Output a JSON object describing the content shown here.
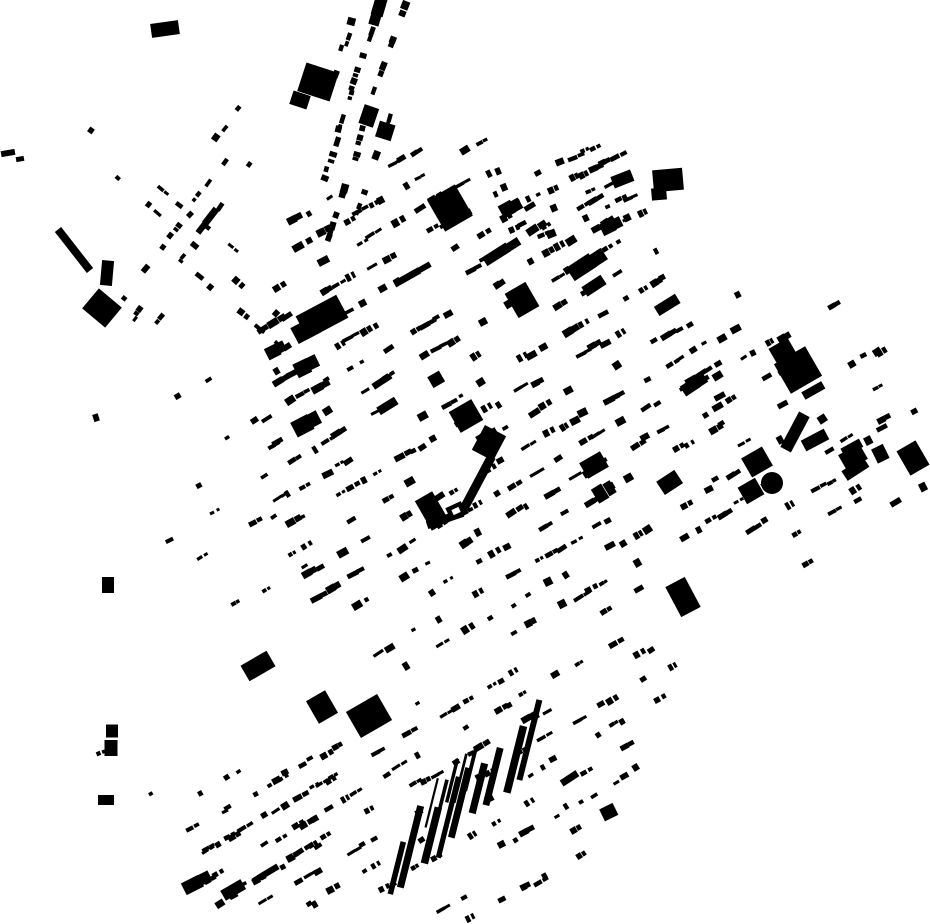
{
  "map": {
    "description": "Figure-ground map: black building footprints on white, city grid rotated about 30 degrees",
    "width": 930,
    "height": 924,
    "background_color": "#ffffff",
    "building_color": "#000000",
    "seed": 1337,
    "grid_angle_deg": -30,
    "districts": [
      {
        "name": "core",
        "angle": -30,
        "cell": [
          14,
          26
        ],
        "prob": 0.62,
        "jitter": 5,
        "block_every": 5,
        "cluster_prob": 0.5,
        "w": [
          4,
          12
        ],
        "h": [
          3,
          8
        ],
        "big_prob": 0.06,
        "poly": [
          [
            295,
            190
          ],
          [
            470,
            128
          ],
          [
            560,
            168
          ],
          [
            660,
            248
          ],
          [
            755,
            400
          ],
          [
            735,
            520
          ],
          [
            640,
            600
          ],
          [
            520,
            650
          ],
          [
            395,
            670
          ],
          [
            300,
            600
          ],
          [
            255,
            450
          ],
          [
            255,
            300
          ]
        ]
      },
      {
        "name": "south",
        "angle": -30,
        "cell": [
          13,
          24
        ],
        "prob": 0.55,
        "jitter": 5,
        "block_every": 5,
        "cluster_prob": 0.5,
        "w": [
          4,
          10
        ],
        "h": [
          3,
          7
        ],
        "big_prob": 0.04,
        "poly": [
          [
            250,
            770
          ],
          [
            420,
            700
          ],
          [
            600,
            640
          ],
          [
            690,
            650
          ],
          [
            640,
            780
          ],
          [
            555,
            900
          ],
          [
            470,
            924
          ],
          [
            240,
            915
          ],
          [
            185,
            850
          ]
        ]
      },
      {
        "name": "east",
        "angle": -30,
        "cell": [
          15,
          30
        ],
        "prob": 0.45,
        "jitter": 6,
        "block_every": 5,
        "cluster_prob": 0.45,
        "w": [
          4,
          11
        ],
        "h": [
          3,
          8
        ],
        "big_prob": 0.1,
        "poly": [
          [
            700,
            280
          ],
          [
            830,
            300
          ],
          [
            880,
            330
          ],
          [
            900,
            420
          ],
          [
            880,
            520
          ],
          [
            800,
            570
          ],
          [
            735,
            540
          ],
          [
            700,
            480
          ],
          [
            685,
            380
          ]
        ]
      },
      {
        "name": "far-east",
        "angle": -30,
        "cell": [
          18,
          36
        ],
        "prob": 0.24,
        "jitter": 7,
        "block_every": 0,
        "cluster_prob": 0.3,
        "w": [
          5,
          12
        ],
        "h": [
          4,
          9
        ],
        "big_prob": 0.15,
        "poly": [
          [
            820,
            300
          ],
          [
            930,
            330
          ],
          [
            930,
            520
          ],
          [
            860,
            540
          ],
          [
            842,
            430
          ],
          [
            828,
            350
          ]
        ]
      },
      {
        "name": "northeast-cluster",
        "angle": -25,
        "cell": [
          12,
          20
        ],
        "prob": 0.62,
        "jitter": 4,
        "block_every": 6,
        "cluster_prob": 0.5,
        "w": [
          4,
          10
        ],
        "h": [
          3,
          8
        ],
        "big_prob": 0.12,
        "poly": [
          [
            492,
            150
          ],
          [
            605,
            146
          ],
          [
            660,
            205
          ],
          [
            612,
            248
          ],
          [
            515,
            235
          ],
          [
            478,
            190
          ]
        ]
      },
      {
        "name": "north-corridor",
        "angle": 108,
        "cell": [
          13,
          22
        ],
        "prob": 0.58,
        "jitter": 4,
        "block_every": 0,
        "cluster_prob": 0.4,
        "w": [
          5,
          10
        ],
        "h": [
          4,
          8
        ],
        "big_prob": 0.05,
        "poly": [
          [
            336,
            0
          ],
          [
            412,
            0
          ],
          [
            374,
            238
          ],
          [
            320,
            238
          ]
        ]
      },
      {
        "name": "nw-corridor-a",
        "angle": 40,
        "cell": [
          13,
          22
        ],
        "prob": 0.5,
        "jitter": 4,
        "block_every": 0,
        "cluster_prob": 0.4,
        "w": [
          4,
          9
        ],
        "h": [
          3,
          7
        ],
        "big_prob": 0.03,
        "poly": [
          [
            46,
            112
          ],
          [
            88,
            98
          ],
          [
            312,
            328
          ],
          [
            272,
            362
          ]
        ]
      },
      {
        "name": "nw-corridor-b",
        "angle": 127,
        "cell": [
          13,
          22
        ],
        "prob": 0.5,
        "jitter": 4,
        "block_every": 0,
        "cluster_prob": 0.4,
        "w": [
          4,
          9
        ],
        "h": [
          3,
          7
        ],
        "big_prob": 0.03,
        "poly": [
          [
            236,
            104
          ],
          [
            274,
            130
          ],
          [
            152,
            332
          ],
          [
            112,
            302
          ]
        ]
      },
      {
        "name": "west-patch",
        "angle": -30,
        "cell": [
          16,
          30
        ],
        "prob": 0.3,
        "jitter": 6,
        "block_every": 5,
        "cluster_prob": 0.4,
        "w": [
          4,
          9
        ],
        "h": [
          3,
          7
        ],
        "big_prob": 0.05,
        "poly": [
          [
            160,
            372
          ],
          [
            282,
            360
          ],
          [
            312,
            558
          ],
          [
            232,
            658
          ],
          [
            150,
            540
          ]
        ]
      },
      {
        "name": "west-strip",
        "angle": -20,
        "cell": [
          22,
          46
        ],
        "prob": 0.15,
        "jitter": 8,
        "block_every": 0,
        "cluster_prob": 0.3,
        "w": [
          4,
          10
        ],
        "h": [
          4,
          8
        ],
        "big_prob": 0.05,
        "poly": [
          [
            88,
            368
          ],
          [
            132,
            368
          ],
          [
            136,
            882
          ],
          [
            96,
            882
          ]
        ]
      },
      {
        "name": "southwest-lower",
        "angle": -30,
        "cell": [
          14,
          26
        ],
        "prob": 0.45,
        "jitter": 5,
        "block_every": 5,
        "cluster_prob": 0.45,
        "w": [
          4,
          9
        ],
        "h": [
          3,
          7
        ],
        "big_prob": 0.03,
        "poly": [
          [
            150,
            792
          ],
          [
            252,
            748
          ],
          [
            332,
            758
          ],
          [
            332,
            918
          ],
          [
            162,
            900
          ]
        ]
      }
    ],
    "bar_groups": [
      {
        "name": "industrial-bars",
        "x1": 398,
        "y1": 866,
        "x2": 528,
        "y2": 744,
        "count": 9,
        "rot": 14,
        "w": [
          5,
          8
        ],
        "len": [
          45,
          85
        ]
      },
      {
        "name": "thin-bars",
        "x1": 430,
        "y1": 800,
        "x2": 470,
        "y2": 768,
        "count": 5,
        "rot": 14,
        "w": [
          2,
          4
        ],
        "len": [
          28,
          55
        ]
      }
    ],
    "landmarks": [
      {
        "name": "plaza-block-ne",
        "type": "rect",
        "cx": 489,
        "cy": 443,
        "w": 24,
        "h": 28,
        "rot": 28
      },
      {
        "name": "plaza-arm-east",
        "type": "rect",
        "cx": 477,
        "cy": 484,
        "w": 9,
        "h": 62,
        "rot": 28
      },
      {
        "name": "plaza-arm-south",
        "type": "rect",
        "cx": 445,
        "cy": 519,
        "w": 38,
        "h": 8,
        "rot": -19
      },
      {
        "name": "plaza-block-sw",
        "type": "rect",
        "cx": 432,
        "cy": 511,
        "w": 20,
        "h": 34,
        "rot": -30
      },
      {
        "name": "plaza-courtyard-house",
        "type": "court",
        "cx": 456,
        "cy": 511,
        "w": 17,
        "h": 14,
        "rot": -25
      },
      {
        "name": "plaza-block-north",
        "type": "rect",
        "cx": 466,
        "cy": 416,
        "w": 26,
        "h": 24,
        "rot": -30
      },
      {
        "name": "west-big-blob",
        "type": "rect",
        "cx": 322,
        "cy": 317,
        "w": 46,
        "h": 26,
        "rot": -28
      },
      {
        "name": "west-big-blob-2",
        "type": "rect",
        "cx": 306,
        "cy": 330,
        "w": 26,
        "h": 18,
        "rot": -28
      },
      {
        "name": "north-big-block",
        "type": "rect",
        "cx": 318,
        "cy": 82,
        "w": 34,
        "h": 30,
        "rot": 18
      },
      {
        "name": "north-big-block-2",
        "type": "rect",
        "cx": 300,
        "cy": 100,
        "w": 18,
        "h": 14,
        "rot": 18
      },
      {
        "name": "ne-big-parallelogram",
        "type": "rect",
        "cx": 450,
        "cy": 208,
        "w": 32,
        "h": 36,
        "rot": -30
      },
      {
        "name": "mid-dark-block",
        "type": "rect",
        "cx": 522,
        "cy": 300,
        "w": 24,
        "h": 28,
        "rot": -30
      },
      {
        "name": "ne-l-building",
        "type": "rect",
        "cx": 668,
        "cy": 180,
        "w": 30,
        "h": 22,
        "rot": -5
      },
      {
        "name": "ne-l-building-2",
        "type": "rect",
        "cx": 659,
        "cy": 194,
        "w": 15,
        "h": 12,
        "rot": -5
      },
      {
        "name": "east-dark-pair-a",
        "type": "rect",
        "cx": 798,
        "cy": 370,
        "w": 36,
        "h": 34,
        "rot": -30
      },
      {
        "name": "east-dark-pair-b",
        "type": "rect",
        "cx": 783,
        "cy": 352,
        "w": 22,
        "h": 20,
        "rot": -30
      },
      {
        "name": "tank-square-north",
        "type": "rect",
        "cx": 757,
        "cy": 462,
        "w": 24,
        "h": 22,
        "rot": -30
      },
      {
        "name": "tank-square-south",
        "type": "rect",
        "cx": 751,
        "cy": 491,
        "w": 20,
        "h": 19,
        "rot": -30
      },
      {
        "name": "tank-circle",
        "type": "circle",
        "cx": 772,
        "cy": 483,
        "r": 11
      },
      {
        "name": "center-dark-block",
        "type": "rect",
        "cx": 594,
        "cy": 465,
        "w": 24,
        "h": 18,
        "rot": -30
      },
      {
        "name": "south-big-1",
        "type": "rect",
        "cx": 369,
        "cy": 716,
        "w": 36,
        "h": 30,
        "rot": -30
      },
      {
        "name": "south-big-2",
        "type": "rect",
        "cx": 322,
        "cy": 707,
        "w": 22,
        "h": 26,
        "rot": -30
      },
      {
        "name": "south-big-3",
        "type": "rect",
        "cx": 258,
        "cy": 666,
        "w": 30,
        "h": 18,
        "rot": -30
      },
      {
        "name": "southeast-dark-block",
        "type": "rect",
        "cx": 683,
        "cy": 597,
        "w": 22,
        "h": 34,
        "rot": -28
      },
      {
        "name": "east-bar-1",
        "type": "rect",
        "cx": 795,
        "cy": 432,
        "w": 12,
        "h": 40,
        "rot": 28
      },
      {
        "name": "east-bar-2",
        "type": "rect",
        "cx": 815,
        "cy": 440,
        "w": 26,
        "h": 12,
        "rot": -28
      },
      {
        "name": "east-square",
        "type": "rect",
        "cx": 853,
        "cy": 457,
        "w": 24,
        "h": 18,
        "rot": -30
      },
      {
        "name": "right-edge-block",
        "type": "rect",
        "cx": 913,
        "cy": 458,
        "w": 22,
        "h": 28,
        "rot": -30
      },
      {
        "name": "topleft-bar",
        "type": "rect",
        "cx": 165,
        "cy": 29,
        "w": 28,
        "h": 14,
        "rot": -8
      },
      {
        "name": "nw-thin-bar",
        "type": "rect",
        "cx": 74,
        "cy": 250,
        "w": 8,
        "h": 52,
        "rot": -38
      },
      {
        "name": "nw-diamond-blob",
        "type": "rect",
        "cx": 102,
        "cy": 308,
        "w": 30,
        "h": 26,
        "rot": 40
      },
      {
        "name": "nw-small-tower",
        "type": "rect",
        "cx": 107,
        "cy": 273,
        "w": 12,
        "h": 25,
        "rot": 5
      },
      {
        "name": "west-dot-1",
        "type": "rect",
        "cx": 108,
        "cy": 585,
        "w": 12,
        "h": 16,
        "rot": 0
      },
      {
        "name": "west-dot-2",
        "type": "rect",
        "cx": 112,
        "cy": 731,
        "w": 12,
        "h": 13,
        "rot": 0
      },
      {
        "name": "west-dot-3",
        "type": "rect",
        "cx": 111,
        "cy": 748,
        "w": 13,
        "h": 16,
        "rot": 0
      },
      {
        "name": "west-dot-4",
        "type": "rect",
        "cx": 106,
        "cy": 800,
        "w": 16,
        "h": 10,
        "rot": 0
      },
      {
        "name": "far-left-speck-1",
        "type": "rect",
        "cx": 8,
        "cy": 153,
        "w": 14,
        "h": 6,
        "rot": -10
      },
      {
        "name": "far-left-speck-2",
        "type": "rect",
        "cx": 20,
        "cy": 159,
        "w": 8,
        "h": 5,
        "rot": -10
      }
    ]
  }
}
